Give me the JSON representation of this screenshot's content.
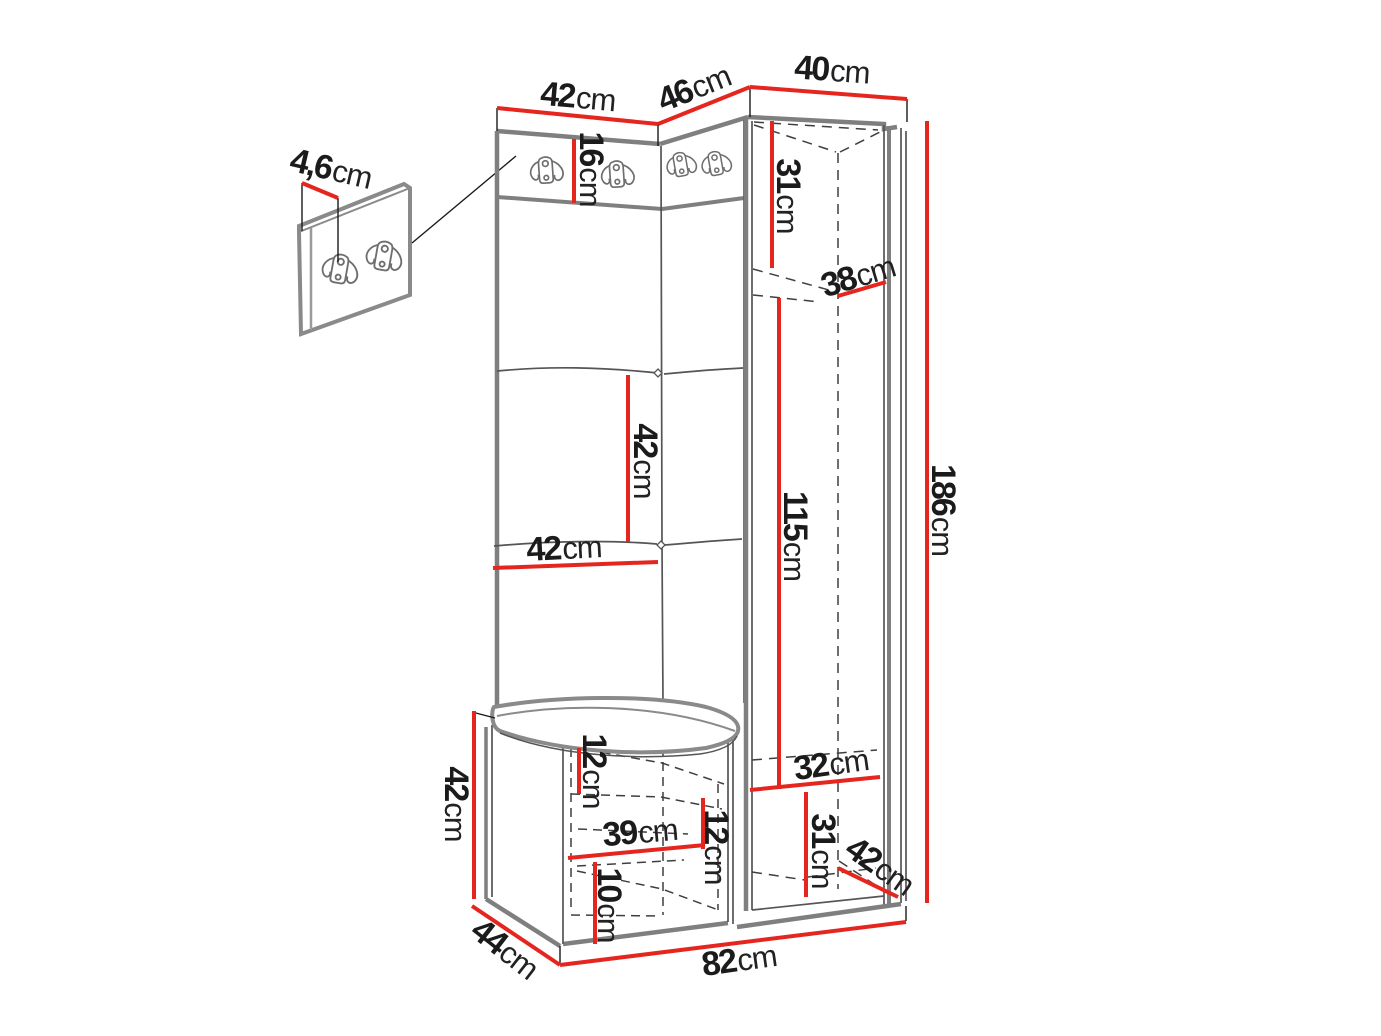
{
  "diagram": {
    "type": "furniture dimension drawing",
    "subject": "corner hallway set: coat-hook panels, tall wardrobe cabinet, upholstered bench with detail inset of hook board",
    "unit": "cm",
    "colors": {
      "dimension_line": "#e5261f",
      "outline": "#7f7f7f",
      "label_text": "#1b1b1b",
      "background": "#ffffff"
    },
    "icons": {
      "coat_hook": "double-coat-hook-icon"
    }
  },
  "dims": {
    "detail_thickness": {
      "value": "4,6",
      "unit": "cm"
    },
    "top_42": {
      "value": "42",
      "unit": "cm"
    },
    "top_46": {
      "value": "46",
      "unit": "cm"
    },
    "top_40": {
      "value": "40",
      "unit": "cm"
    },
    "strip_16": {
      "value": "16",
      "unit": "cm"
    },
    "upper_31": {
      "value": "31",
      "unit": "cm"
    },
    "depth_38": {
      "value": "38",
      "unit": "cm"
    },
    "mid_42_v": {
      "value": "42",
      "unit": "cm"
    },
    "mid_42_h": {
      "value": "42",
      "unit": "cm"
    },
    "height_115": {
      "value": "115",
      "unit": "cm"
    },
    "height_186": {
      "value": "186",
      "unit": "cm"
    },
    "bench_42": {
      "value": "42",
      "unit": "cm"
    },
    "seat_12": {
      "value": "12",
      "unit": "cm"
    },
    "width_39": {
      "value": "39",
      "unit": "cm"
    },
    "shelf_12": {
      "value": "12",
      "unit": "cm"
    },
    "height_10": {
      "value": "10",
      "unit": "cm"
    },
    "depth_44": {
      "value": "44",
      "unit": "cm"
    },
    "width_82": {
      "value": "82",
      "unit": "cm"
    },
    "width_32": {
      "value": "32",
      "unit": "cm"
    },
    "lower_31": {
      "value": "31",
      "unit": "cm"
    },
    "depth_42": {
      "value": "42",
      "unit": "cm"
    }
  }
}
